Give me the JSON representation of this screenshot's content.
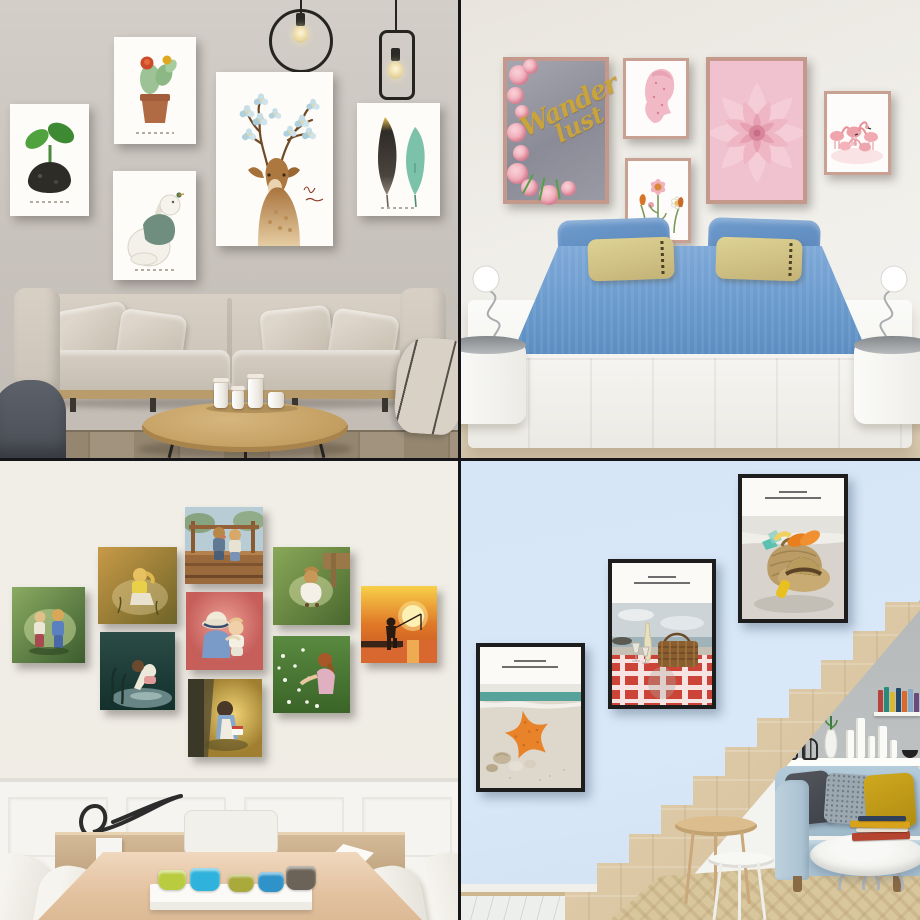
{
  "collage": {
    "layout": "2x2 grid of interior photos with wall-art posters",
    "divider_color": "#15151a"
  },
  "living_room": {
    "title": "living room watercolor gallery wall",
    "wall_color": "#cac4be",
    "floor_color": "#9a8c78",
    "pendant_lamps": [
      "ring-pendant-with-bulb",
      "rectangle-pendant-with-bulb"
    ],
    "posters": {
      "sprout": {
        "subject": "green seedling sprout on dark pebble",
        "caption_script_illegible": true,
        "colors": [
          "#4fa23e",
          "#2b2a26"
        ]
      },
      "cactus": {
        "subject": "potted cactus with red and yellow blooms",
        "caption_script_illegible": true,
        "colors": [
          "#9cc296",
          "#cc4a2a",
          "#e0a81e",
          "#b06a44"
        ]
      },
      "bunny": {
        "subject": "bunny in green sweater looking up at tiny bird",
        "caption_script_illegible": true,
        "colors": [
          "#6f8e80"
        ]
      },
      "deer": {
        "subject": "watercolor deer with blossoming antlers and script text",
        "caption_script_illegible": true,
        "colors": [
          "#ad7840",
          "#bed9e2"
        ]
      },
      "feathers": {
        "subject": "two feathers: dark with gold tip, teal",
        "caption_script_illegible": true,
        "colors": [
          "#2f2b27",
          "#e8c050",
          "#7cc2aa"
        ]
      }
    },
    "furniture": {
      "sofa": "beige fabric sofa with cushions and pillows",
      "coffee_table": "round wooden coffee table with white ceramic jars",
      "armchair": "dark grey armchair",
      "throw": "beige throw blanket"
    }
  },
  "bedroom": {
    "title": "bedroom with pink botanical posters",
    "wall_color": "#eeebe5",
    "floor_color": "#d9cbb0",
    "posters": {
      "wanderlust": {
        "text_line1": "Wander",
        "text_line2": "lust",
        "text_color": "#c9a33b",
        "background": "#93939f",
        "frame_color": "#c5988c",
        "subject": "pink roses on grey concrete with gold script"
      },
      "blossom_profile": {
        "subject": "pink floral woman profile silhouette"
      },
      "wildflowers": {
        "subject": "pastel wildflower illustration"
      },
      "pink_succulent": {
        "subject": "pink succulent flower close-up"
      },
      "flamingos": {
        "subject": "flock of pink flamingos"
      }
    },
    "bed": {
      "mattress_color": "#6d9ed0",
      "pillows": [
        "blue",
        "blue",
        "khaki-striped",
        "khaki-striped"
      ],
      "platform_color": "#f6f5f2"
    },
    "nightstands": "white round nightstands with glass tops and spiral wire lamps"
  },
  "dining_room": {
    "title": "dining room with children oil-painting canvases",
    "wall_color": "#f0ede6",
    "paintings": [
      {
        "id": "toddlers-green",
        "subject": "two toddlers face to face on green meadow"
      },
      {
        "id": "girl-crouching-amber",
        "subject": "girl in yellow crouching in amber field"
      },
      {
        "id": "girl-pond",
        "subject": "girl bending over a dark pond"
      },
      {
        "id": "kids-bridge",
        "subject": "two kids sitting together on a wooden bridge"
      },
      {
        "id": "girl-hat-baby",
        "subject": "girl in sun hat hugging baby on pink background"
      },
      {
        "id": "girl-reading-tree",
        "subject": "girl in blue dress reading under a tree"
      },
      {
        "id": "girl-white-dress",
        "subject": "girl in white dress crouching by a porch"
      },
      {
        "id": "girl-daisy-field",
        "subject": "girl playing in a daisy field"
      },
      {
        "id": "boy-fishing-sunset",
        "subject": "boy fishing from a pier at sunset"
      }
    ],
    "furniture": {
      "table": "light wood dining table",
      "chairs": "white upholstered dining chairs",
      "sideboard": "wooden sideboard with black ribbon sculpture and white origami decor",
      "tray": "white tray with colored glass cups",
      "cup_colors": [
        "#b9cc40",
        "#2fb3dc",
        "#a9a93c",
        "#2f92c8",
        "#6b6357"
      ]
    }
  },
  "stair_room": {
    "title": "staircase wall with beach photography posters",
    "wall_color": "#d8e7f8",
    "posters": [
      {
        "id": "starfish",
        "subject": "orange starfish and shells on the beach",
        "caption_legible": false
      },
      {
        "id": "picnic",
        "subject": "picnic basket and wine on red gingham blanket by the sea",
        "caption_legible": false
      },
      {
        "id": "beach-hat",
        "subject": "straw hat, straw bag and flip-flops on sand",
        "caption_legible": false
      }
    ],
    "stairs_color": "#e2d1b2",
    "sofa": {
      "color": "#aac6d6",
      "pillow_colors": [
        "#4c5157",
        "#9ba8b0",
        "#c7a01c"
      ]
    },
    "decor": [
      "black wire lanterns",
      "vase with green sprig",
      "white candles",
      "colorful books",
      "round marble coffee table with book stack",
      "wooden and white nesting side tables",
      "beige patterned rug",
      "marble floor"
    ]
  }
}
